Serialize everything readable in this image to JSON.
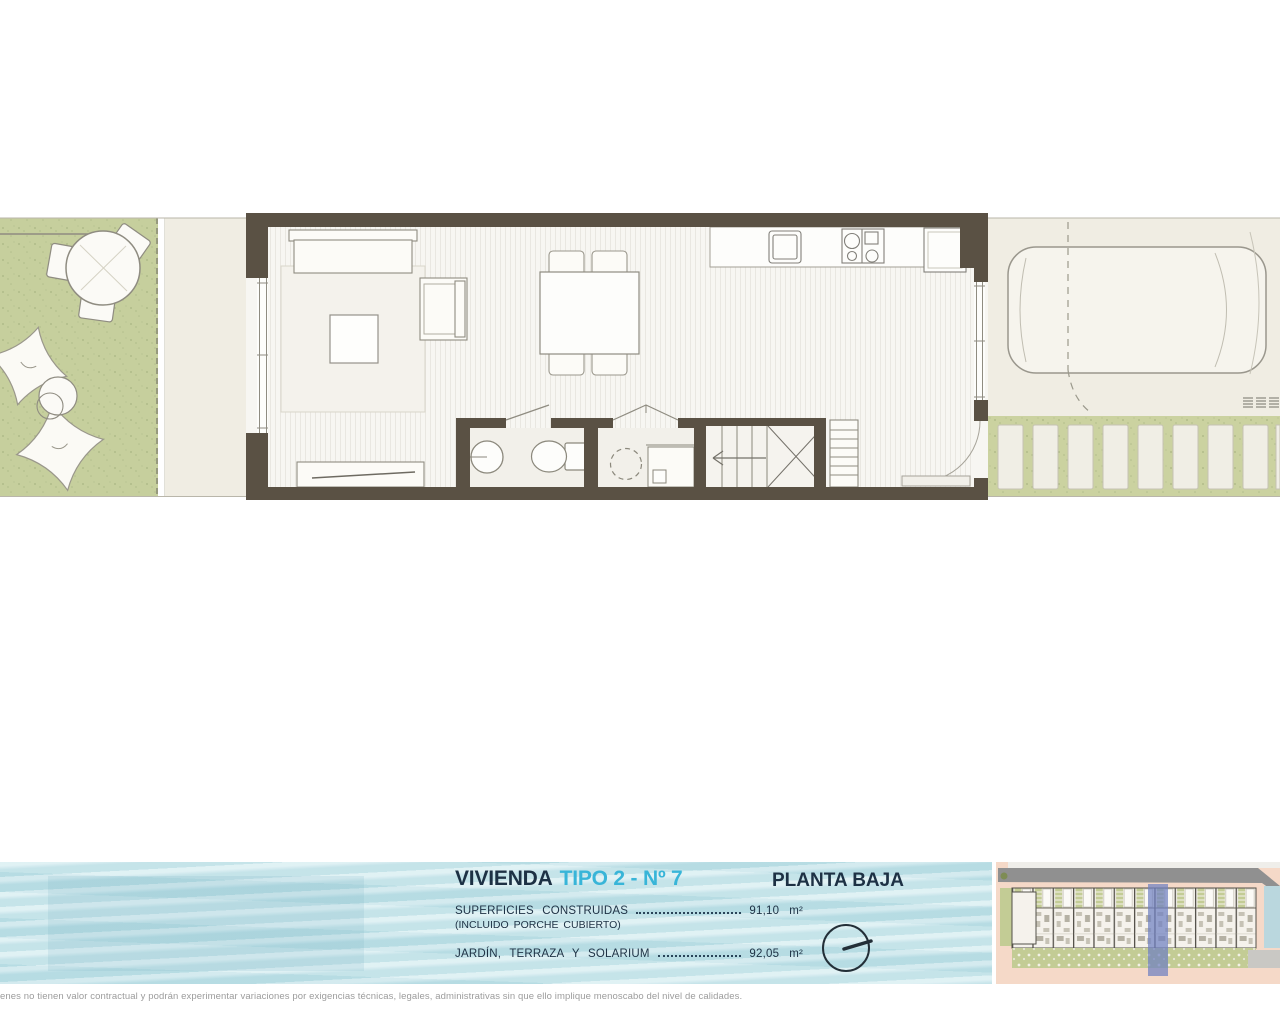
{
  "document": {
    "type": "architectural-floor-plan-sheet",
    "disclaimer": "enes no tienen valor contractual y podrán experimentar variaciones por exigencias técnicas, legales, administrativas sin que ello implique menoscabo del nivel de calidades."
  },
  "footer": {
    "title": {
      "prefix": "VIVIENDA",
      "highlight": "TIPO 2 - Nº 7"
    },
    "plan_name": "PLANTA BAJA",
    "specs": [
      {
        "label": "SUPERFICIES CONSTRUIDAS",
        "sublabel": "(INCLUIDO PORCHE CUBIERTO)",
        "value": "91,10",
        "unit": "m²"
      },
      {
        "label": "JARDÍN, TERRAZA Y SOLARIUM",
        "sublabel": "",
        "value": "92,05",
        "unit": "m²"
      }
    ],
    "compass_icon": "north-indicator",
    "colors": {
      "navy": "#1d3144",
      "cyan": "#38b5d8",
      "water_blue": "#cae6eb"
    }
  },
  "site_plan": {
    "background_pink": "#f5d9c8",
    "road_gray": "#909090",
    "garden_green": "#c3cc95",
    "highlighted_unit_color": "#6f7fc0",
    "pool_blue": "#bad7de"
  },
  "plan": {
    "wall_color": "#5a5144",
    "garden_green": "#c6cf9d",
    "walkway_green": "#cbd2a0",
    "floor": "#f7f6f2",
    "paving_beige": "#f0ede3"
  }
}
